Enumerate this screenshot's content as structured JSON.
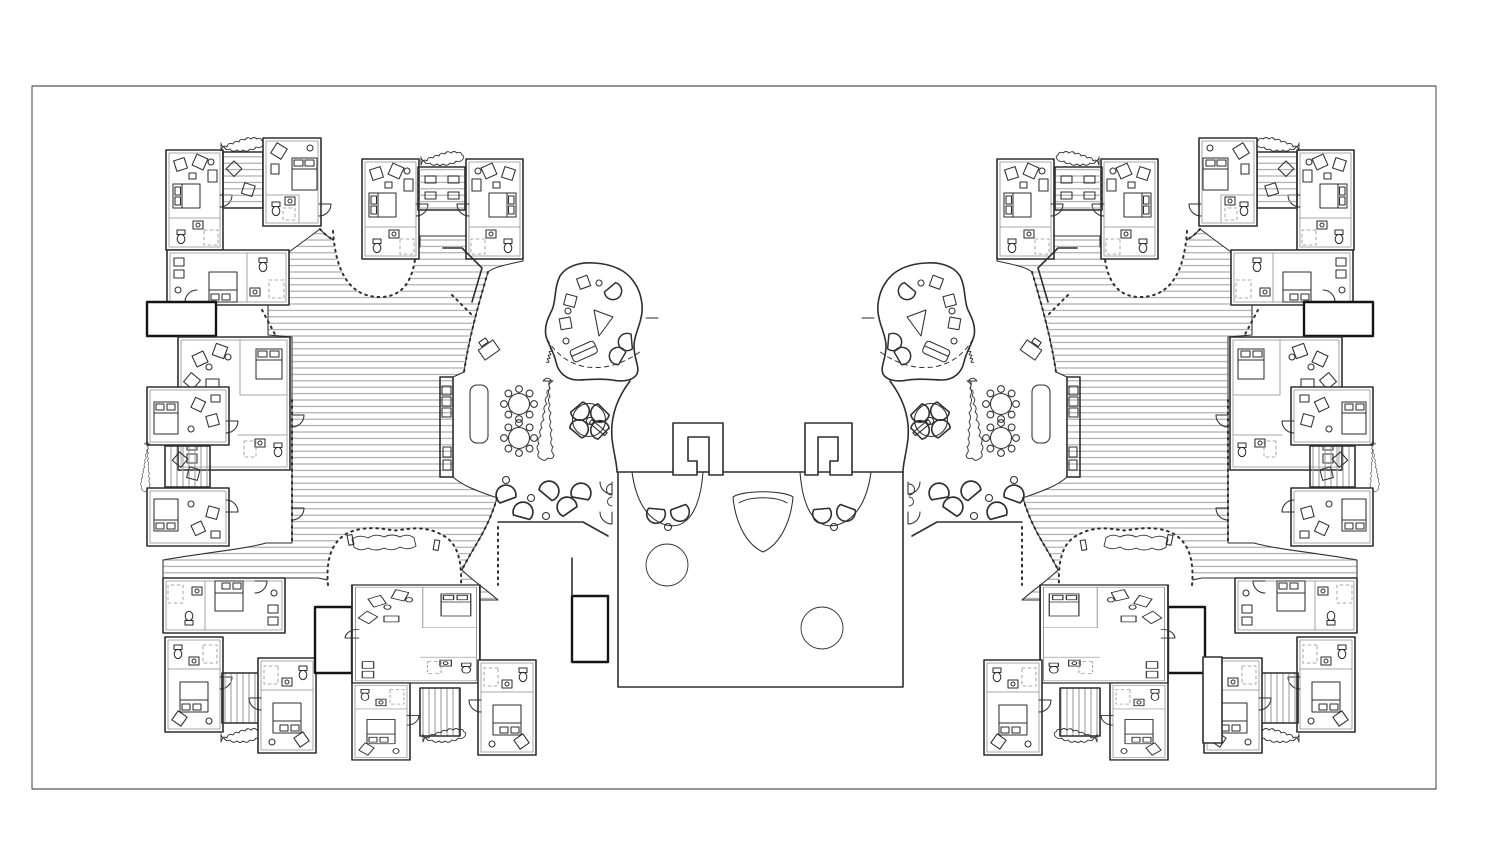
{
  "meta": {
    "title": "Symmetric twin-wing residential floor plan",
    "drawing_type": "architectural line drawing, ink on white",
    "description": "Mirrored east/west wings of corner apartment clusters linked by hatched ramp corridors to amoeba-shaped common rooms, dining areas and a shared central hall."
  },
  "colors": {
    "paper": "#ffffff",
    "ink": "#2e2e2e",
    "ink_bold": "#141414",
    "hatch_line": "#9b9b9b"
  },
  "frame": {
    "label": "drawing border"
  },
  "wings": {
    "west": {
      "label": "west wing",
      "apartment_units": 17,
      "shared_patios": 5,
      "blob_common_rooms": 1,
      "dining_tables_8_seat": 2,
      "round_group_tables": 1,
      "bench_niches": 1
    },
    "east": {
      "label": "east wing (mirror of west)",
      "apartment_units": 17,
      "shared_patios": 5,
      "blob_common_rooms": 1,
      "dining_tables_8_seat": 2,
      "round_group_tables": 1,
      "bench_niches": 1
    }
  },
  "central_hall": {
    "label": "central hall",
    "stair_cores": 2,
    "washroom_bays": 2,
    "skylight_circles": 2,
    "fan_stage": 1,
    "annex_rooms": 2
  },
  "legend": {
    "icons": [
      "bed",
      "pillow",
      "wardrobe",
      "lounge-chair",
      "sofa",
      "toilet",
      "washbasin",
      "shower",
      "door-swing",
      "dining-table-8-seats",
      "round-group-table",
      "desk-with-chair",
      "planter-hedge",
      "vertical-shrub",
      "deck-hatching",
      "stair-core",
      "skylight-circle",
      "fan-stage",
      "bench-niche",
      "scatter-seat"
    ]
  }
}
